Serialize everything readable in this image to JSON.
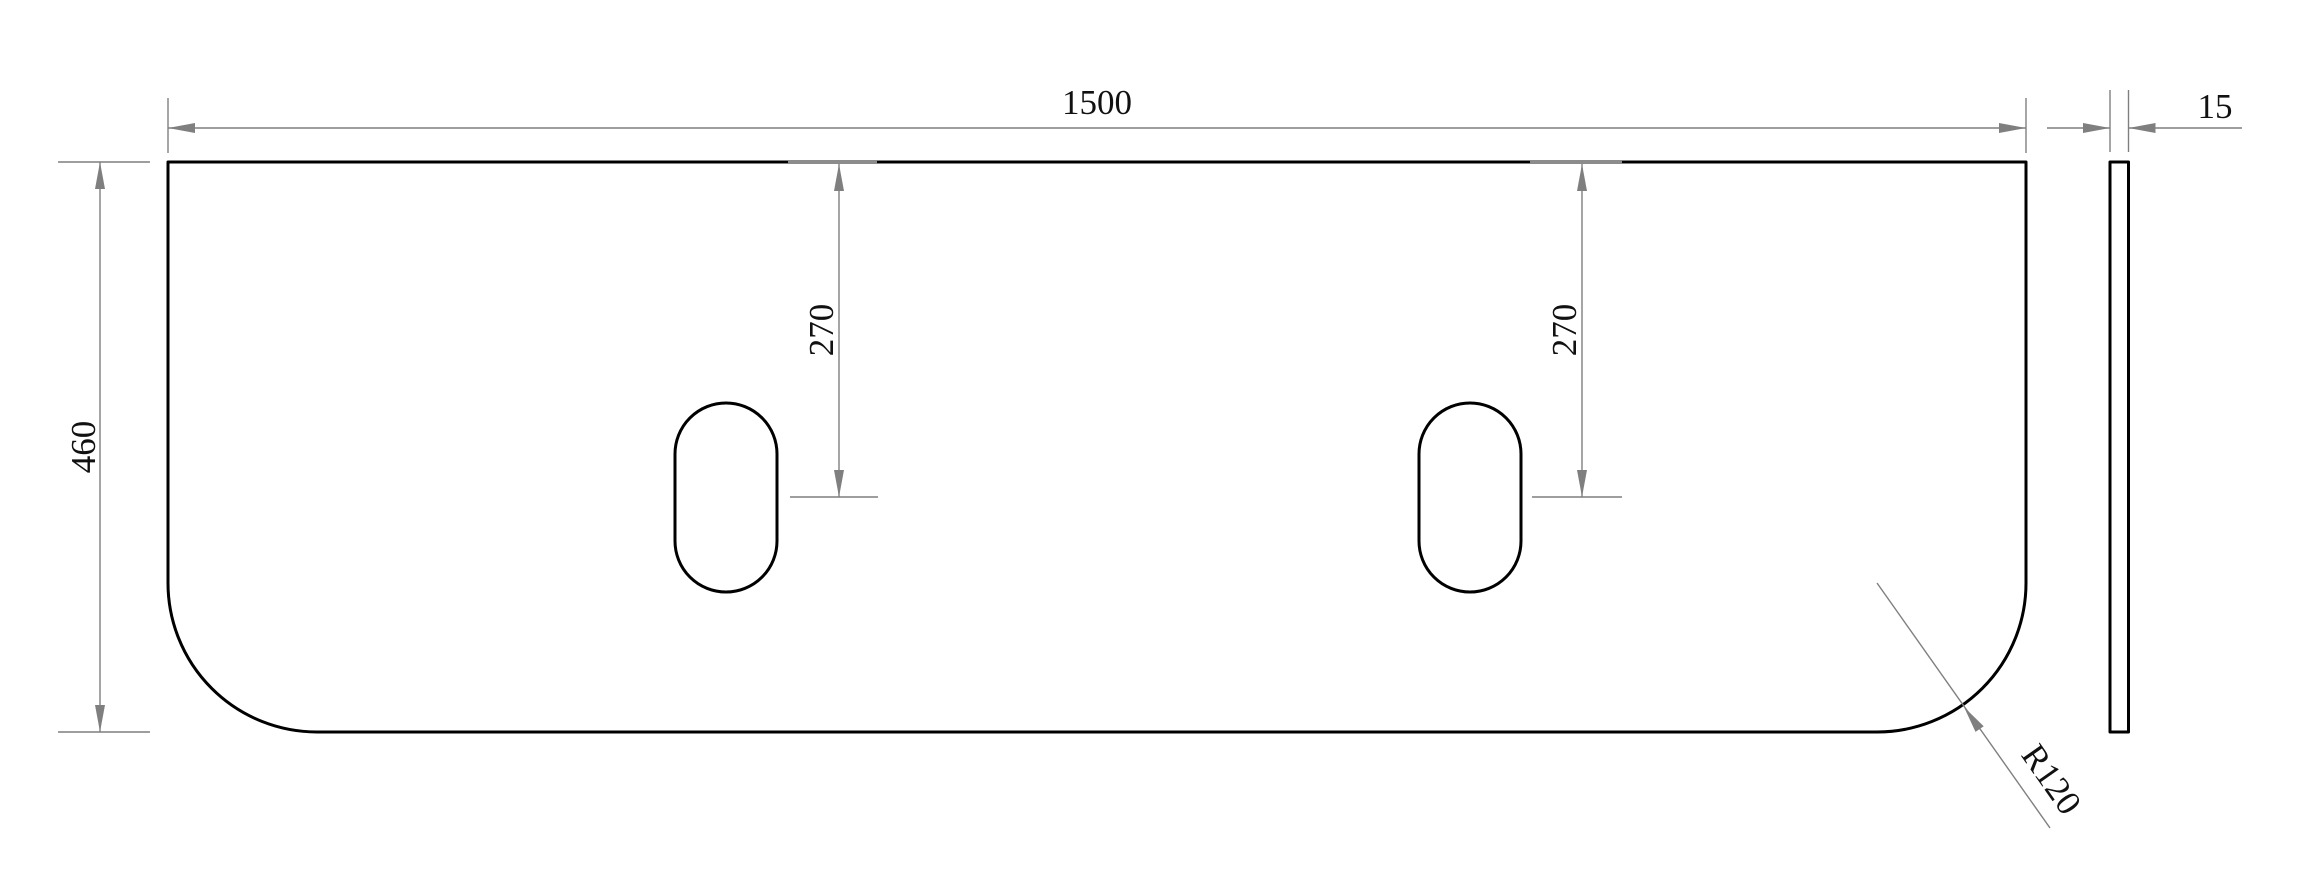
{
  "drawing": {
    "type": "engineering-drawing",
    "units": "mm",
    "part": {
      "width_mm": 1500,
      "height_mm": 460,
      "thickness_mm": 15,
      "bottom_corner_radius_mm": 120,
      "slot_center_offset_from_top_mm": 270,
      "slot_count": 2
    },
    "views": {
      "front": {
        "label": "front view"
      },
      "side": {
        "label": "side profile view"
      }
    },
    "dimensions": {
      "width": "1500",
      "height": "460",
      "thickness": "15",
      "slot_left_offset": "270",
      "slot_right_offset": "270",
      "corner_radius": "R120"
    },
    "colors": {
      "outline": "#000000",
      "dimension_lines": "#7f7f7f",
      "text": "#111111",
      "background": "#ffffff"
    }
  }
}
